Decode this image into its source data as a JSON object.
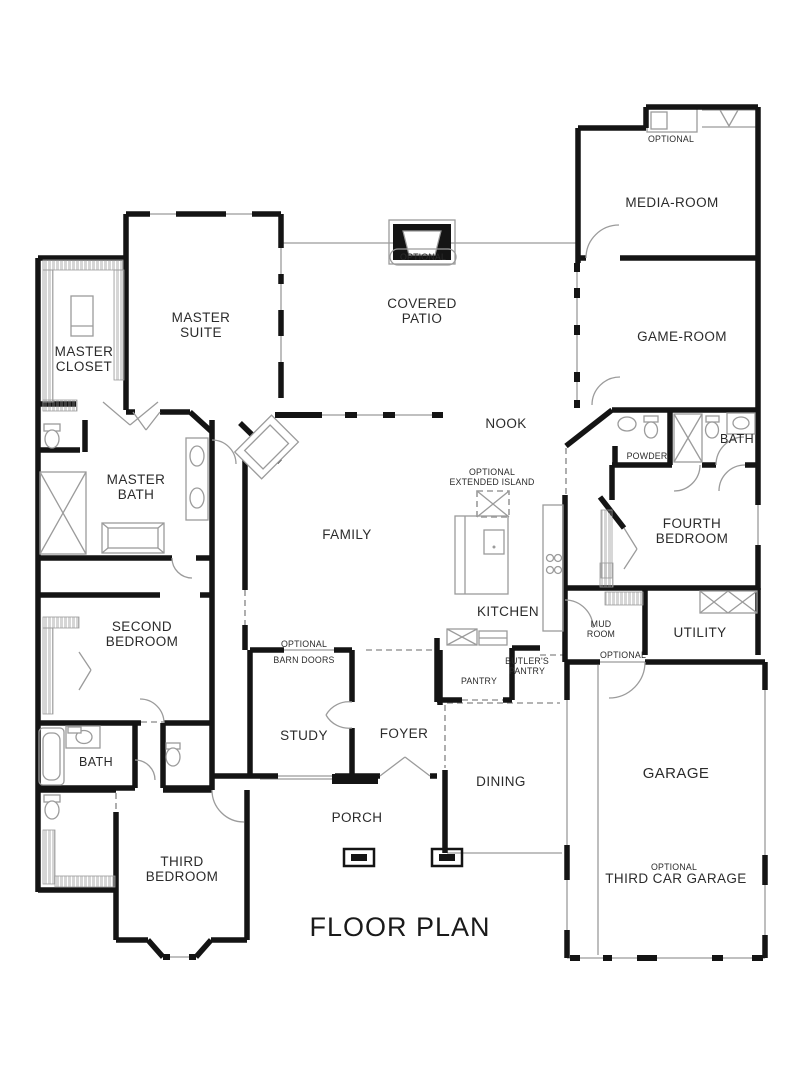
{
  "title": "FLOOR PLAN",
  "colors": {
    "background": "#ffffff",
    "wall": "#141414",
    "thin_line": "#9b9b9b",
    "label": "#2b2b2b"
  },
  "labels": {
    "media_room": "MEDIA-ROOM",
    "media_optional": "OPTIONAL",
    "covered_patio_1": "COVERED",
    "covered_patio_2": "PATIO",
    "patio_optional": "OPTIONAL",
    "game_room": "GAME-ROOM",
    "master_suite_1": "MASTER",
    "master_suite_2": "SUITE",
    "master_closet_1": "MASTER",
    "master_closet_2": "CLOSET",
    "master_bath_1": "MASTER",
    "master_bath_2": "BATH",
    "nook": "NOOK",
    "island_optional_1": "OPTIONAL",
    "island_optional_2": "EXTENDED ISLAND",
    "family": "FAMILY",
    "kitchen": "KITCHEN",
    "powder": "POWDER",
    "bath_right": "BATH",
    "fourth_bedroom_1": "FOURTH",
    "fourth_bedroom_2": "BEDROOM",
    "mud_room_1": "MUD",
    "mud_room_2": "ROOM",
    "utility": "UTILITY",
    "mud_optional": "OPTIONAL",
    "second_bedroom_1": "SECOND",
    "second_bedroom_2": "BEDROOM",
    "bath_left": "BATH",
    "barn_doors_1": "OPTIONAL",
    "barn_doors_2": "BARN DOORS",
    "study": "STUDY",
    "foyer": "FOYER",
    "pantry": "PANTRY",
    "butlers_pantry_1": "BUTLER'S",
    "butlers_pantry_2": "PANTRY",
    "dining": "DINING",
    "porch": "PORCH",
    "third_bedroom_1": "THIRD",
    "third_bedroom_2": "BEDROOM",
    "garage": "GARAGE",
    "third_car_garage_1": "OPTIONAL",
    "third_car_garage_2": "THIRD CAR GARAGE"
  }
}
